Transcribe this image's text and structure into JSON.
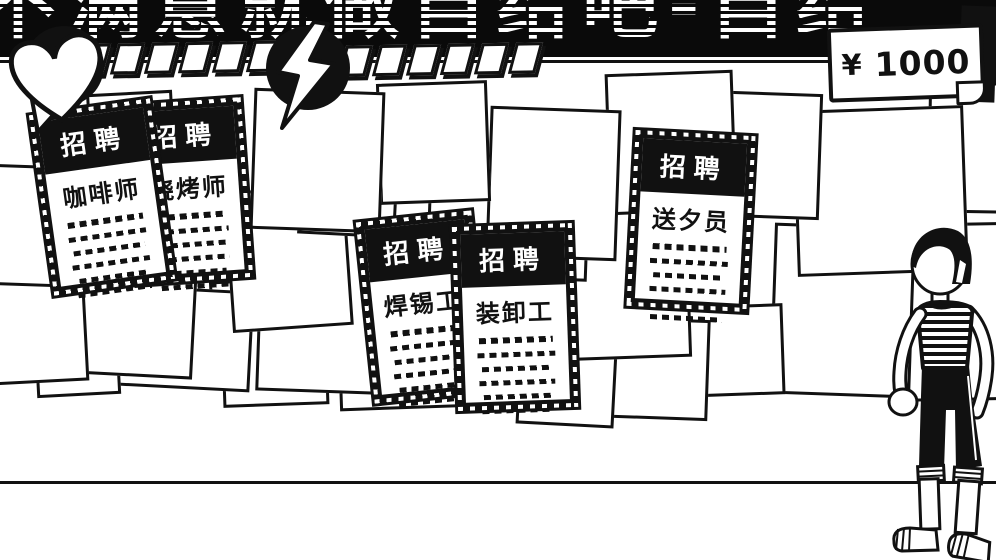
{
  "banner": {
    "text": "不满意就做自给吧-自给"
  },
  "hud": {
    "health": {
      "icon": "heart-icon",
      "segments": 7
    },
    "energy": {
      "icon": "lightning-icon",
      "segments": 6
    },
    "money": {
      "currency": "¥",
      "amount": "1000"
    }
  },
  "posters": [
    {
      "header": "招聘",
      "title": "咖啡师",
      "text_lines": 6
    },
    {
      "header": "招聘",
      "title": "烧烤师",
      "text_lines": 6
    },
    {
      "header": "招聘",
      "title": "焊锡工",
      "text_lines": 6
    },
    {
      "header": "招聘",
      "title": "装卸工",
      "text_lines": 6
    },
    {
      "header": "招聘",
      "title": "送夕员",
      "text_lines": 6
    }
  ],
  "colors": {
    "ink": "#111111",
    "paper": "#ffffff",
    "banner_bg": "#0a0a0a"
  }
}
